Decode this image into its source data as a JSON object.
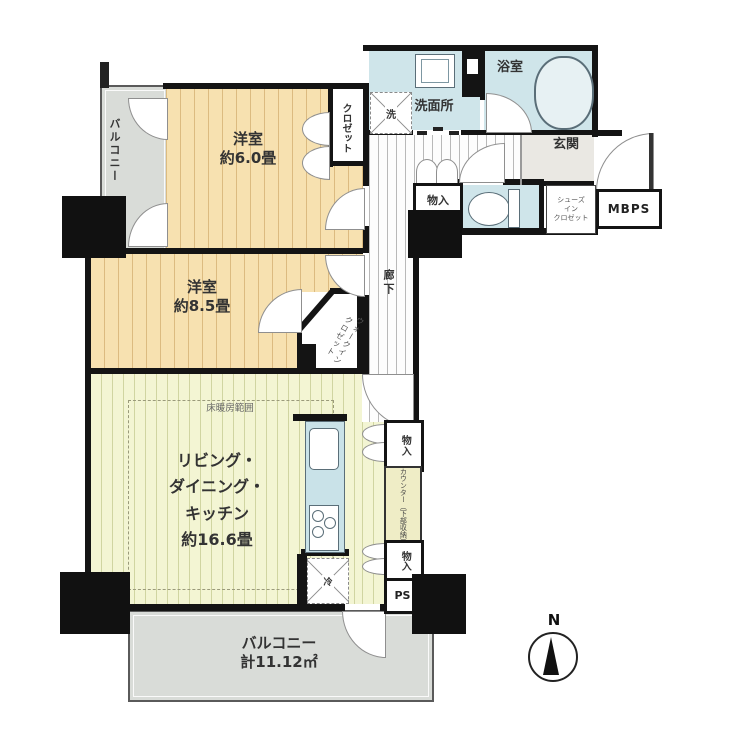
{
  "colors": {
    "wall": "#141414",
    "tatami": "#f7e1b0",
    "ldk": "#f3f5d3",
    "water": "#cfe5ea",
    "balcony": "#d9dcd8",
    "counter_bg": "#efedc6"
  },
  "rooms": {
    "balcony_left": {
      "label": "バルコニー"
    },
    "bedroom_6": {
      "name": "洋室",
      "size": "約6.0畳"
    },
    "closet": {
      "label": "クロゼット"
    },
    "washroom": {
      "label": "洗面所"
    },
    "washer": {
      "label": "洗"
    },
    "bathroom": {
      "label": "浴室"
    },
    "entrance": {
      "label": "玄関"
    },
    "hall_storage": {
      "label": "物入"
    },
    "shoe_closet": {
      "lines": [
        "シューズ",
        "イン",
        "クロゼット"
      ]
    },
    "mbps": {
      "label": "MBPS"
    },
    "corridor": {
      "label": "廊下"
    },
    "bedroom_85": {
      "name": "洋室",
      "size": "約8.5畳"
    },
    "walk_in_closet": {
      "lines": [
        "ウォークイン",
        "クロゼット"
      ]
    },
    "ldk": {
      "lines": [
        "リビング・",
        "ダイニング・",
        "キッチン",
        "約16.6畳"
      ]
    },
    "floor_heating": {
      "label": "床暖房範囲"
    },
    "kitchen_storage_upper": {
      "label": "物入"
    },
    "counter": {
      "label": "カウンター（下部収納）"
    },
    "kitchen_storage_lower": {
      "label": "物入"
    },
    "pipe_space": {
      "label": "PS"
    },
    "refrigerator": {
      "label": "冷"
    },
    "balcony_bottom": {
      "line1": "バルコニー",
      "line2": "計11.12㎡"
    },
    "compass": {
      "label": "N"
    }
  }
}
